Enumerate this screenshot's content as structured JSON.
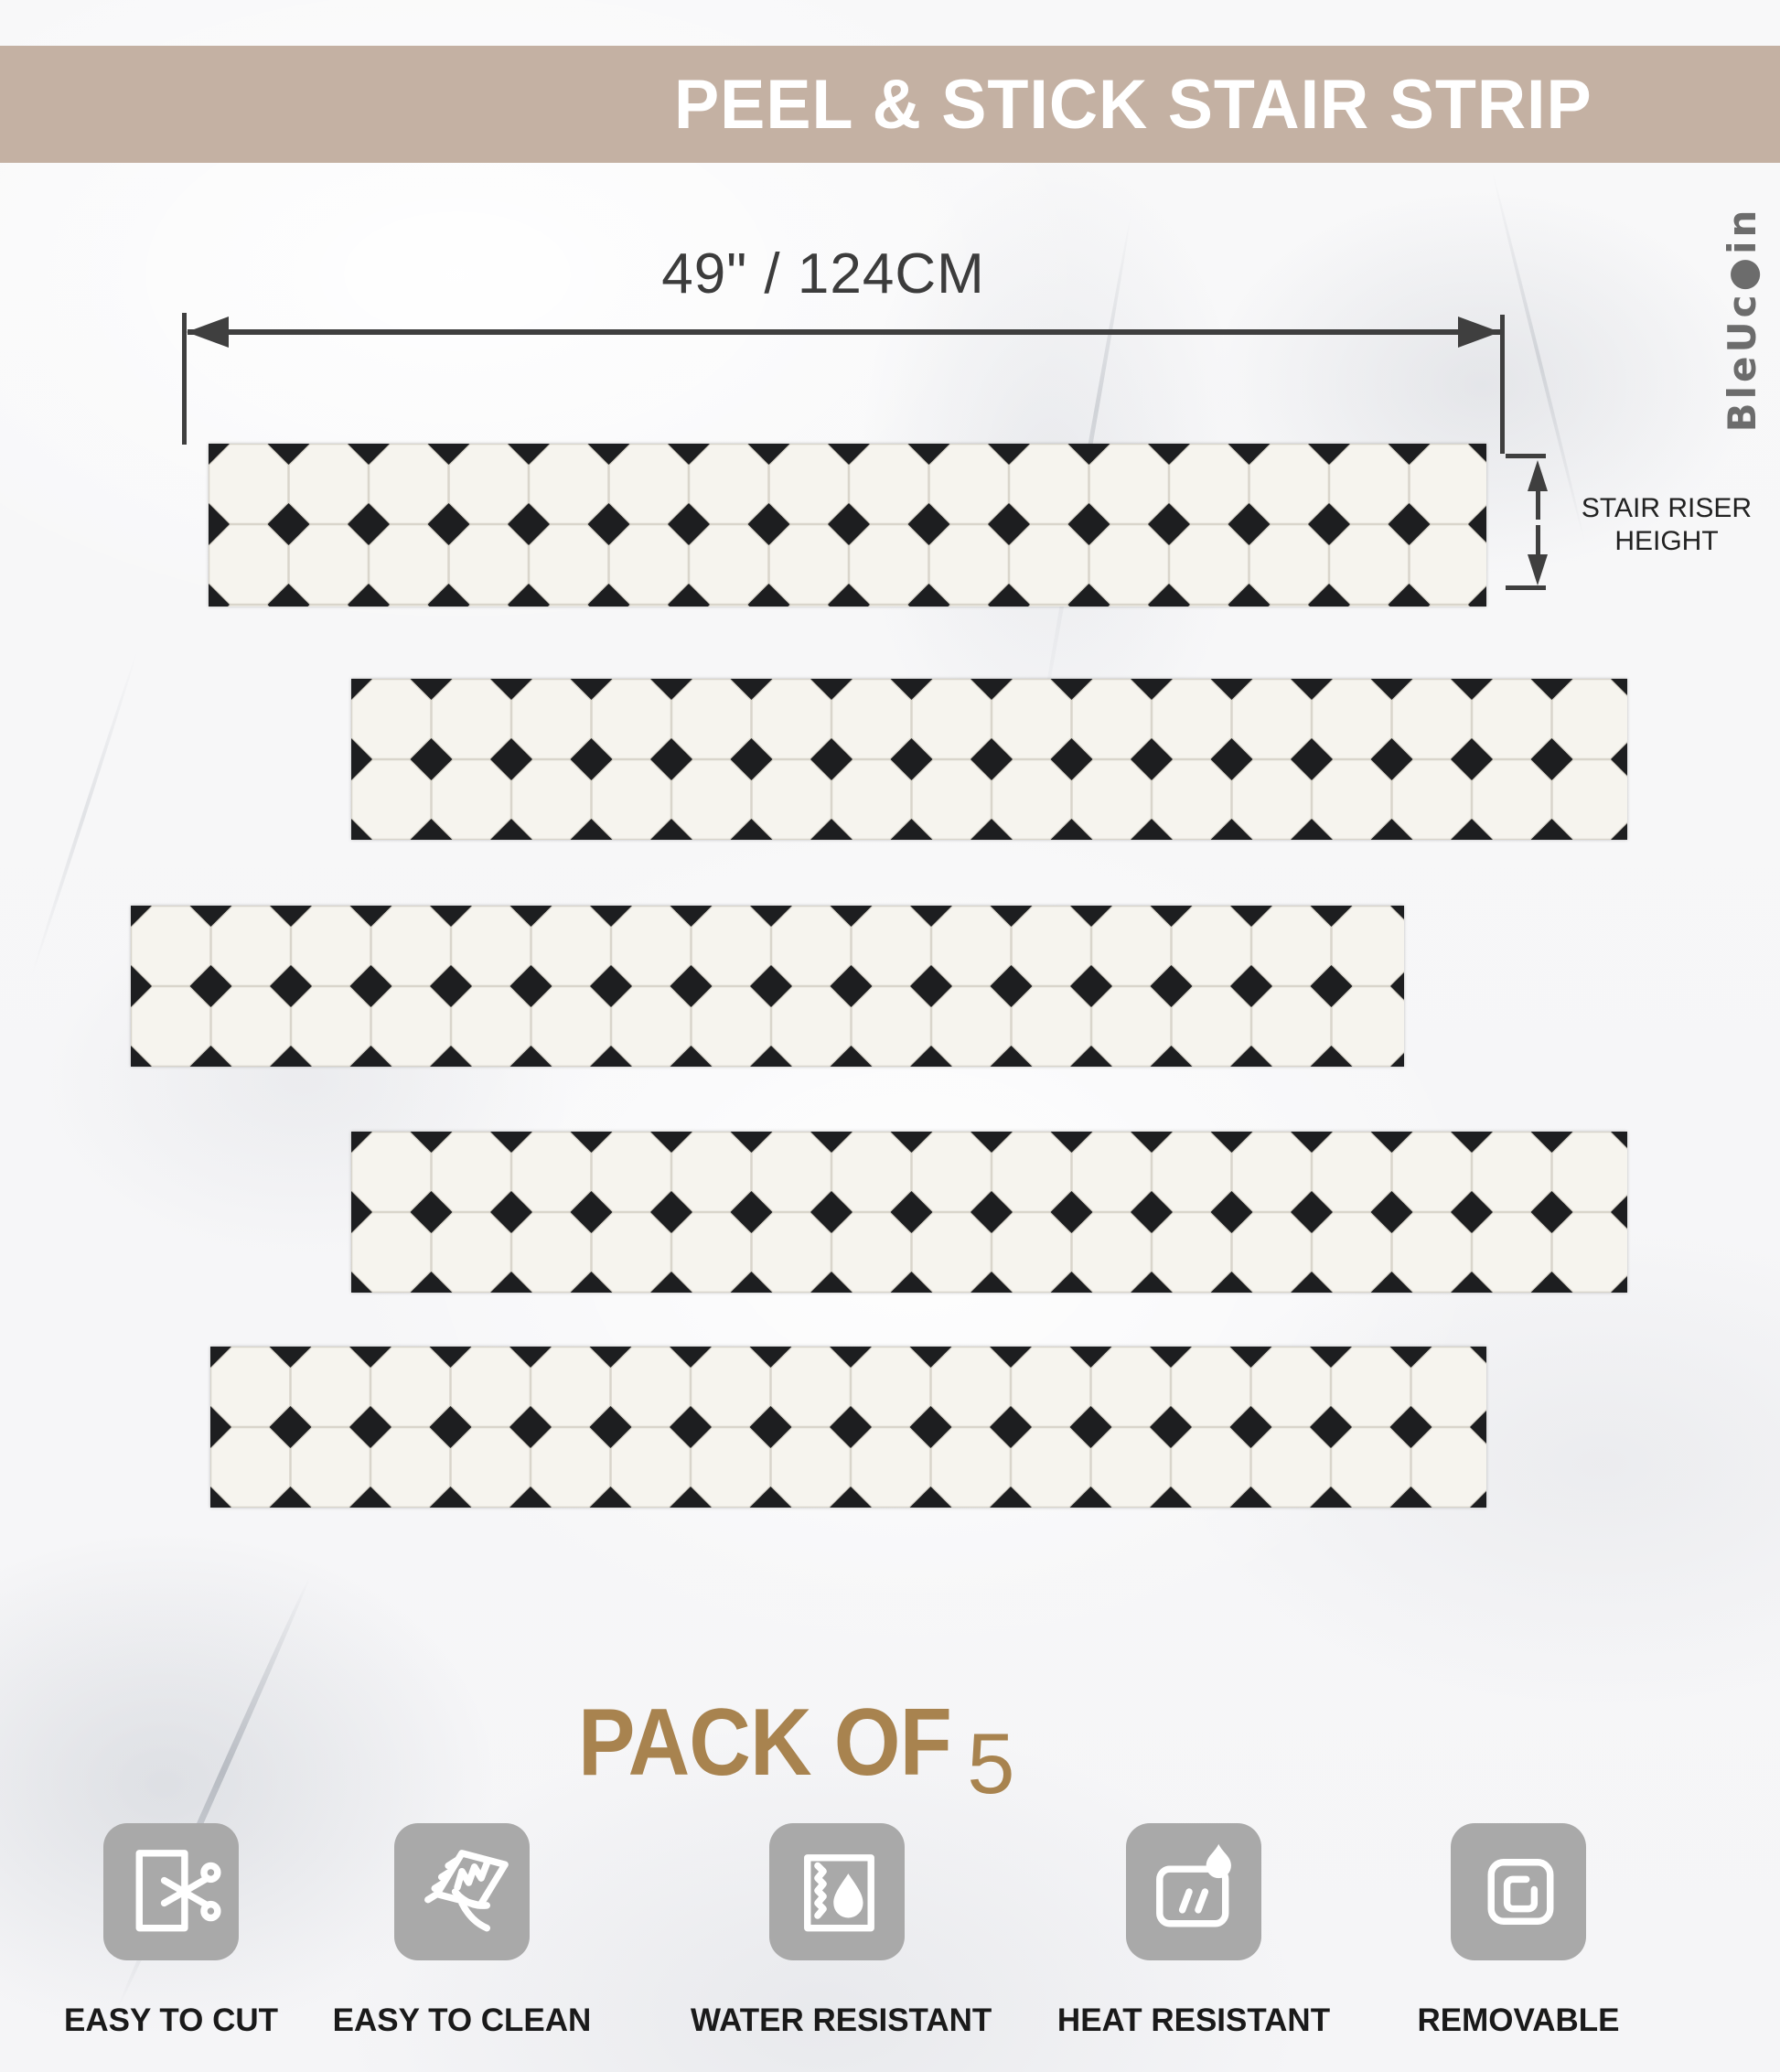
{
  "banner": {
    "title": "PEEL & STICK STAIR STRIP"
  },
  "brand": {
    "name": "BleUcoin",
    "display": "BleUc●in"
  },
  "dimensions": {
    "width_label": "49\" / 124CM",
    "riser_line1": "STAIR RISER",
    "riser_line2": "HEIGHT"
  },
  "pack": {
    "label": "PACK OF",
    "count": "5"
  },
  "strips": {
    "count": 5,
    "pattern": "black-and-white octagon dot tile"
  },
  "features": [
    {
      "label": "EASY TO CUT",
      "icon": "scissors-cut-icon"
    },
    {
      "label": "EASY TO CLEAN",
      "icon": "hand-wipe-icon"
    },
    {
      "label": "WATER RESISTANT",
      "icon": "water-drop-icon"
    },
    {
      "label": "HEAT RESISTANT",
      "icon": "flame-icon"
    },
    {
      "label": "REMOVABLE",
      "icon": "peel-corner-icon"
    }
  ],
  "colors": {
    "banner_bg": "#c4b1a3",
    "banner_text": "#ffffff",
    "pack_text": "#a8834f",
    "dimension": "#3f3f3f",
    "tile_black": "#1d1e20",
    "tile_white": "#f6f4ee",
    "grout": "#d9d5cb",
    "icon_bg": "#a9a9a9",
    "label_text": "#1a1a1a",
    "logo_gray": "#6c6c6c"
  }
}
